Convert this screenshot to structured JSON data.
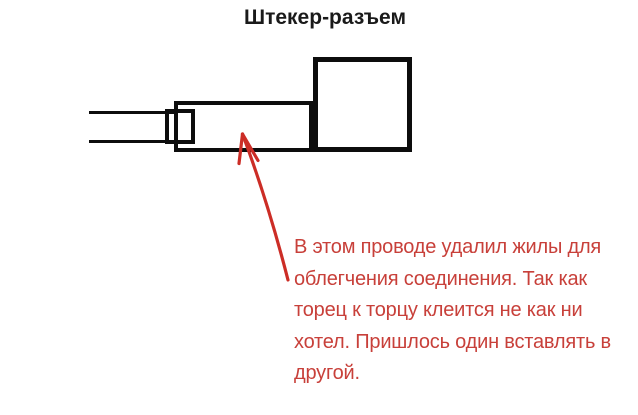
{
  "title": "Штекер-разъем",
  "annotation": {
    "lines": [
      "В этом проводе удалил жилы для",
      "облегчения соединения. Так как",
      "торец к торцу клеится не как ни",
      "хотел. Пришлось один вставлять в",
      "другой."
    ],
    "full_text": "В этом проводе удалил жилы для облегчения соединения. Так как торец к торцу клеится не как ни хотел. Пришлось один вставлять в другой."
  },
  "colors": {
    "background": "#ffffff",
    "title_text": "#1a1a1a",
    "diagram_line": "#0d0d0d",
    "arrow_red": "#cc2d26",
    "annotation_red": "#c8403a"
  }
}
